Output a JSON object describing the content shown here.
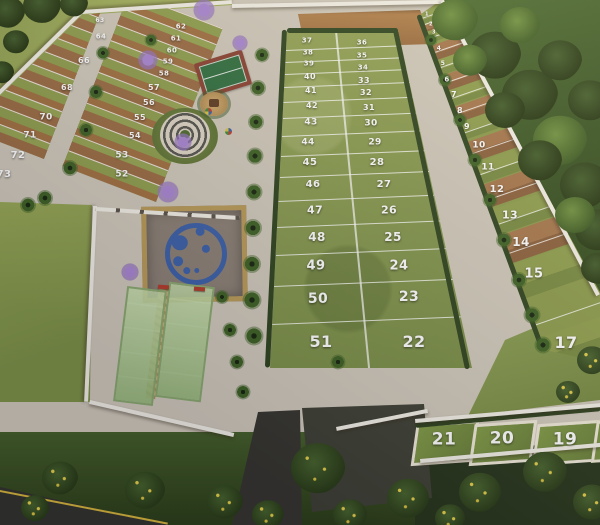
{
  "plots": {
    "west_block_outer_column": [
      {
        "n": "63",
        "x": 100,
        "y": 21,
        "s": 6
      },
      {
        "n": "64",
        "x": 101,
        "y": 37,
        "s": 7
      },
      {
        "n": "66",
        "x": 84,
        "y": 61,
        "s": 8
      },
      {
        "n": "68",
        "x": 67,
        "y": 88,
        "s": 8
      },
      {
        "n": "70",
        "x": 46,
        "y": 118,
        "s": 9
      },
      {
        "n": "71",
        "x": 30,
        "y": 136,
        "s": 9
      },
      {
        "n": "72",
        "x": 18,
        "y": 156,
        "s": 10
      },
      {
        "n": "73",
        "x": 4,
        "y": 175,
        "s": 10
      }
    ],
    "west_block_inner_column": [
      {
        "n": "62",
        "x": 181,
        "y": 27,
        "s": 7
      },
      {
        "n": "61",
        "x": 176,
        "y": 39,
        "s": 7
      },
      {
        "n": "60",
        "x": 172,
        "y": 51,
        "s": 7
      },
      {
        "n": "59",
        "x": 168,
        "y": 62,
        "s": 7
      },
      {
        "n": "58",
        "x": 164,
        "y": 74,
        "s": 7
      },
      {
        "n": "57",
        "x": 154,
        "y": 88,
        "s": 8
      },
      {
        "n": "56",
        "x": 149,
        "y": 103,
        "s": 8
      },
      {
        "n": "55",
        "x": 140,
        "y": 118,
        "s": 8
      },
      {
        "n": "54",
        "x": 135,
        "y": 136,
        "s": 8
      },
      {
        "n": "53",
        "x": 122,
        "y": 156,
        "s": 9
      },
      {
        "n": "52",
        "x": 122,
        "y": 175,
        "s": 9
      }
    ],
    "center_block_west_column": [
      {
        "n": "37",
        "x": 307,
        "y": 41,
        "s": 7
      },
      {
        "n": "38",
        "x": 308,
        "y": 53,
        "s": 7
      },
      {
        "n": "39",
        "x": 309,
        "y": 64,
        "s": 7
      },
      {
        "n": "40",
        "x": 310,
        "y": 77,
        "s": 8
      },
      {
        "n": "41",
        "x": 311,
        "y": 91,
        "s": 8
      },
      {
        "n": "42",
        "x": 312,
        "y": 106,
        "s": 8
      },
      {
        "n": "43",
        "x": 311,
        "y": 123,
        "s": 9
      },
      {
        "n": "44",
        "x": 308,
        "y": 143,
        "s": 9
      },
      {
        "n": "45",
        "x": 310,
        "y": 163,
        "s": 10
      },
      {
        "n": "46",
        "x": 313,
        "y": 185,
        "s": 10
      },
      {
        "n": "47",
        "x": 315,
        "y": 210,
        "s": 11
      },
      {
        "n": "48",
        "x": 317,
        "y": 237,
        "s": 12
      },
      {
        "n": "49",
        "x": 316,
        "y": 266,
        "s": 13
      },
      {
        "n": "50",
        "x": 318,
        "y": 299,
        "s": 14
      },
      {
        "n": "51",
        "x": 321,
        "y": 342,
        "s": 16
      }
    ],
    "center_block_east_column": [
      {
        "n": "36",
        "x": 362,
        "y": 43,
        "s": 7
      },
      {
        "n": "35",
        "x": 362,
        "y": 56,
        "s": 7
      },
      {
        "n": "34",
        "x": 363,
        "y": 68,
        "s": 7
      },
      {
        "n": "33",
        "x": 364,
        "y": 81,
        "s": 8
      },
      {
        "n": "32",
        "x": 366,
        "y": 93,
        "s": 8
      },
      {
        "n": "31",
        "x": 369,
        "y": 108,
        "s": 8
      },
      {
        "n": "30",
        "x": 371,
        "y": 124,
        "s": 9
      },
      {
        "n": "29",
        "x": 375,
        "y": 143,
        "s": 9
      },
      {
        "n": "28",
        "x": 377,
        "y": 163,
        "s": 10
      },
      {
        "n": "27",
        "x": 384,
        "y": 185,
        "s": 10
      },
      {
        "n": "26",
        "x": 389,
        "y": 210,
        "s": 11
      },
      {
        "n": "25",
        "x": 393,
        "y": 237,
        "s": 12
      },
      {
        "n": "24",
        "x": 399,
        "y": 266,
        "s": 13
      },
      {
        "n": "23",
        "x": 409,
        "y": 297,
        "s": 14
      },
      {
        "n": "22",
        "x": 414,
        "y": 342,
        "s": 16
      }
    ],
    "east_block_column": [
      {
        "n": "1",
        "x": 427,
        "y": 15,
        "s": 5
      },
      {
        "n": "2",
        "x": 431,
        "y": 25,
        "s": 5
      },
      {
        "n": "3",
        "x": 434,
        "y": 33,
        "s": 5
      },
      {
        "n": "4",
        "x": 439,
        "y": 49,
        "s": 6
      },
      {
        "n": "5",
        "x": 443,
        "y": 64,
        "s": 6
      },
      {
        "n": "6",
        "x": 447,
        "y": 80,
        "s": 7
      },
      {
        "n": "7",
        "x": 454,
        "y": 95,
        "s": 8
      },
      {
        "n": "8",
        "x": 460,
        "y": 111,
        "s": 8
      },
      {
        "n": "9",
        "x": 467,
        "y": 127,
        "s": 8
      },
      {
        "n": "10",
        "x": 479,
        "y": 146,
        "s": 9
      },
      {
        "n": "11",
        "x": 488,
        "y": 168,
        "s": 9
      },
      {
        "n": "12",
        "x": 497,
        "y": 190,
        "s": 10
      },
      {
        "n": "13",
        "x": 510,
        "y": 215,
        "s": 11
      },
      {
        "n": "14",
        "x": 521,
        "y": 242,
        "s": 12
      },
      {
        "n": "15",
        "x": 534,
        "y": 274,
        "s": 13
      },
      {
        "n": "17",
        "x": 566,
        "y": 343,
        "s": 16
      }
    ],
    "south_row": [
      {
        "n": "21",
        "x": 444,
        "y": 440,
        "s": 17
      },
      {
        "n": "20",
        "x": 502,
        "y": 439,
        "s": 17
      },
      {
        "n": "19",
        "x": 565,
        "y": 440,
        "s": 17
      }
    ]
  },
  "amenities": {
    "tennis_court": "tennis-court",
    "playground": "playground-sandpit",
    "spiral_plaza": "spiral-stone-plaza",
    "logo_plaza": "blue-circles-logo-plaza",
    "padel_courts": "glass-padel-courts",
    "benches": "red-benches",
    "cleared_lot": "cleared-dirt-lot",
    "entrance_road": "entrance-road"
  },
  "colors": {
    "grass_plot": "#8a9a4a",
    "dirt_plot": "#9c6b42",
    "concrete_path": "#cfc8ba",
    "wall_white": "#f2efe6",
    "forest_dark": "#3d5626",
    "lawn_light": "#a3b25c",
    "hedge": "#2c421c",
    "court_green": "#2f6e3e",
    "court_red": "#8a4030",
    "logo_blue": "#3a5fa8",
    "jacaranda_purple": "#9f7fc9",
    "label_white": "#ffffff"
  }
}
